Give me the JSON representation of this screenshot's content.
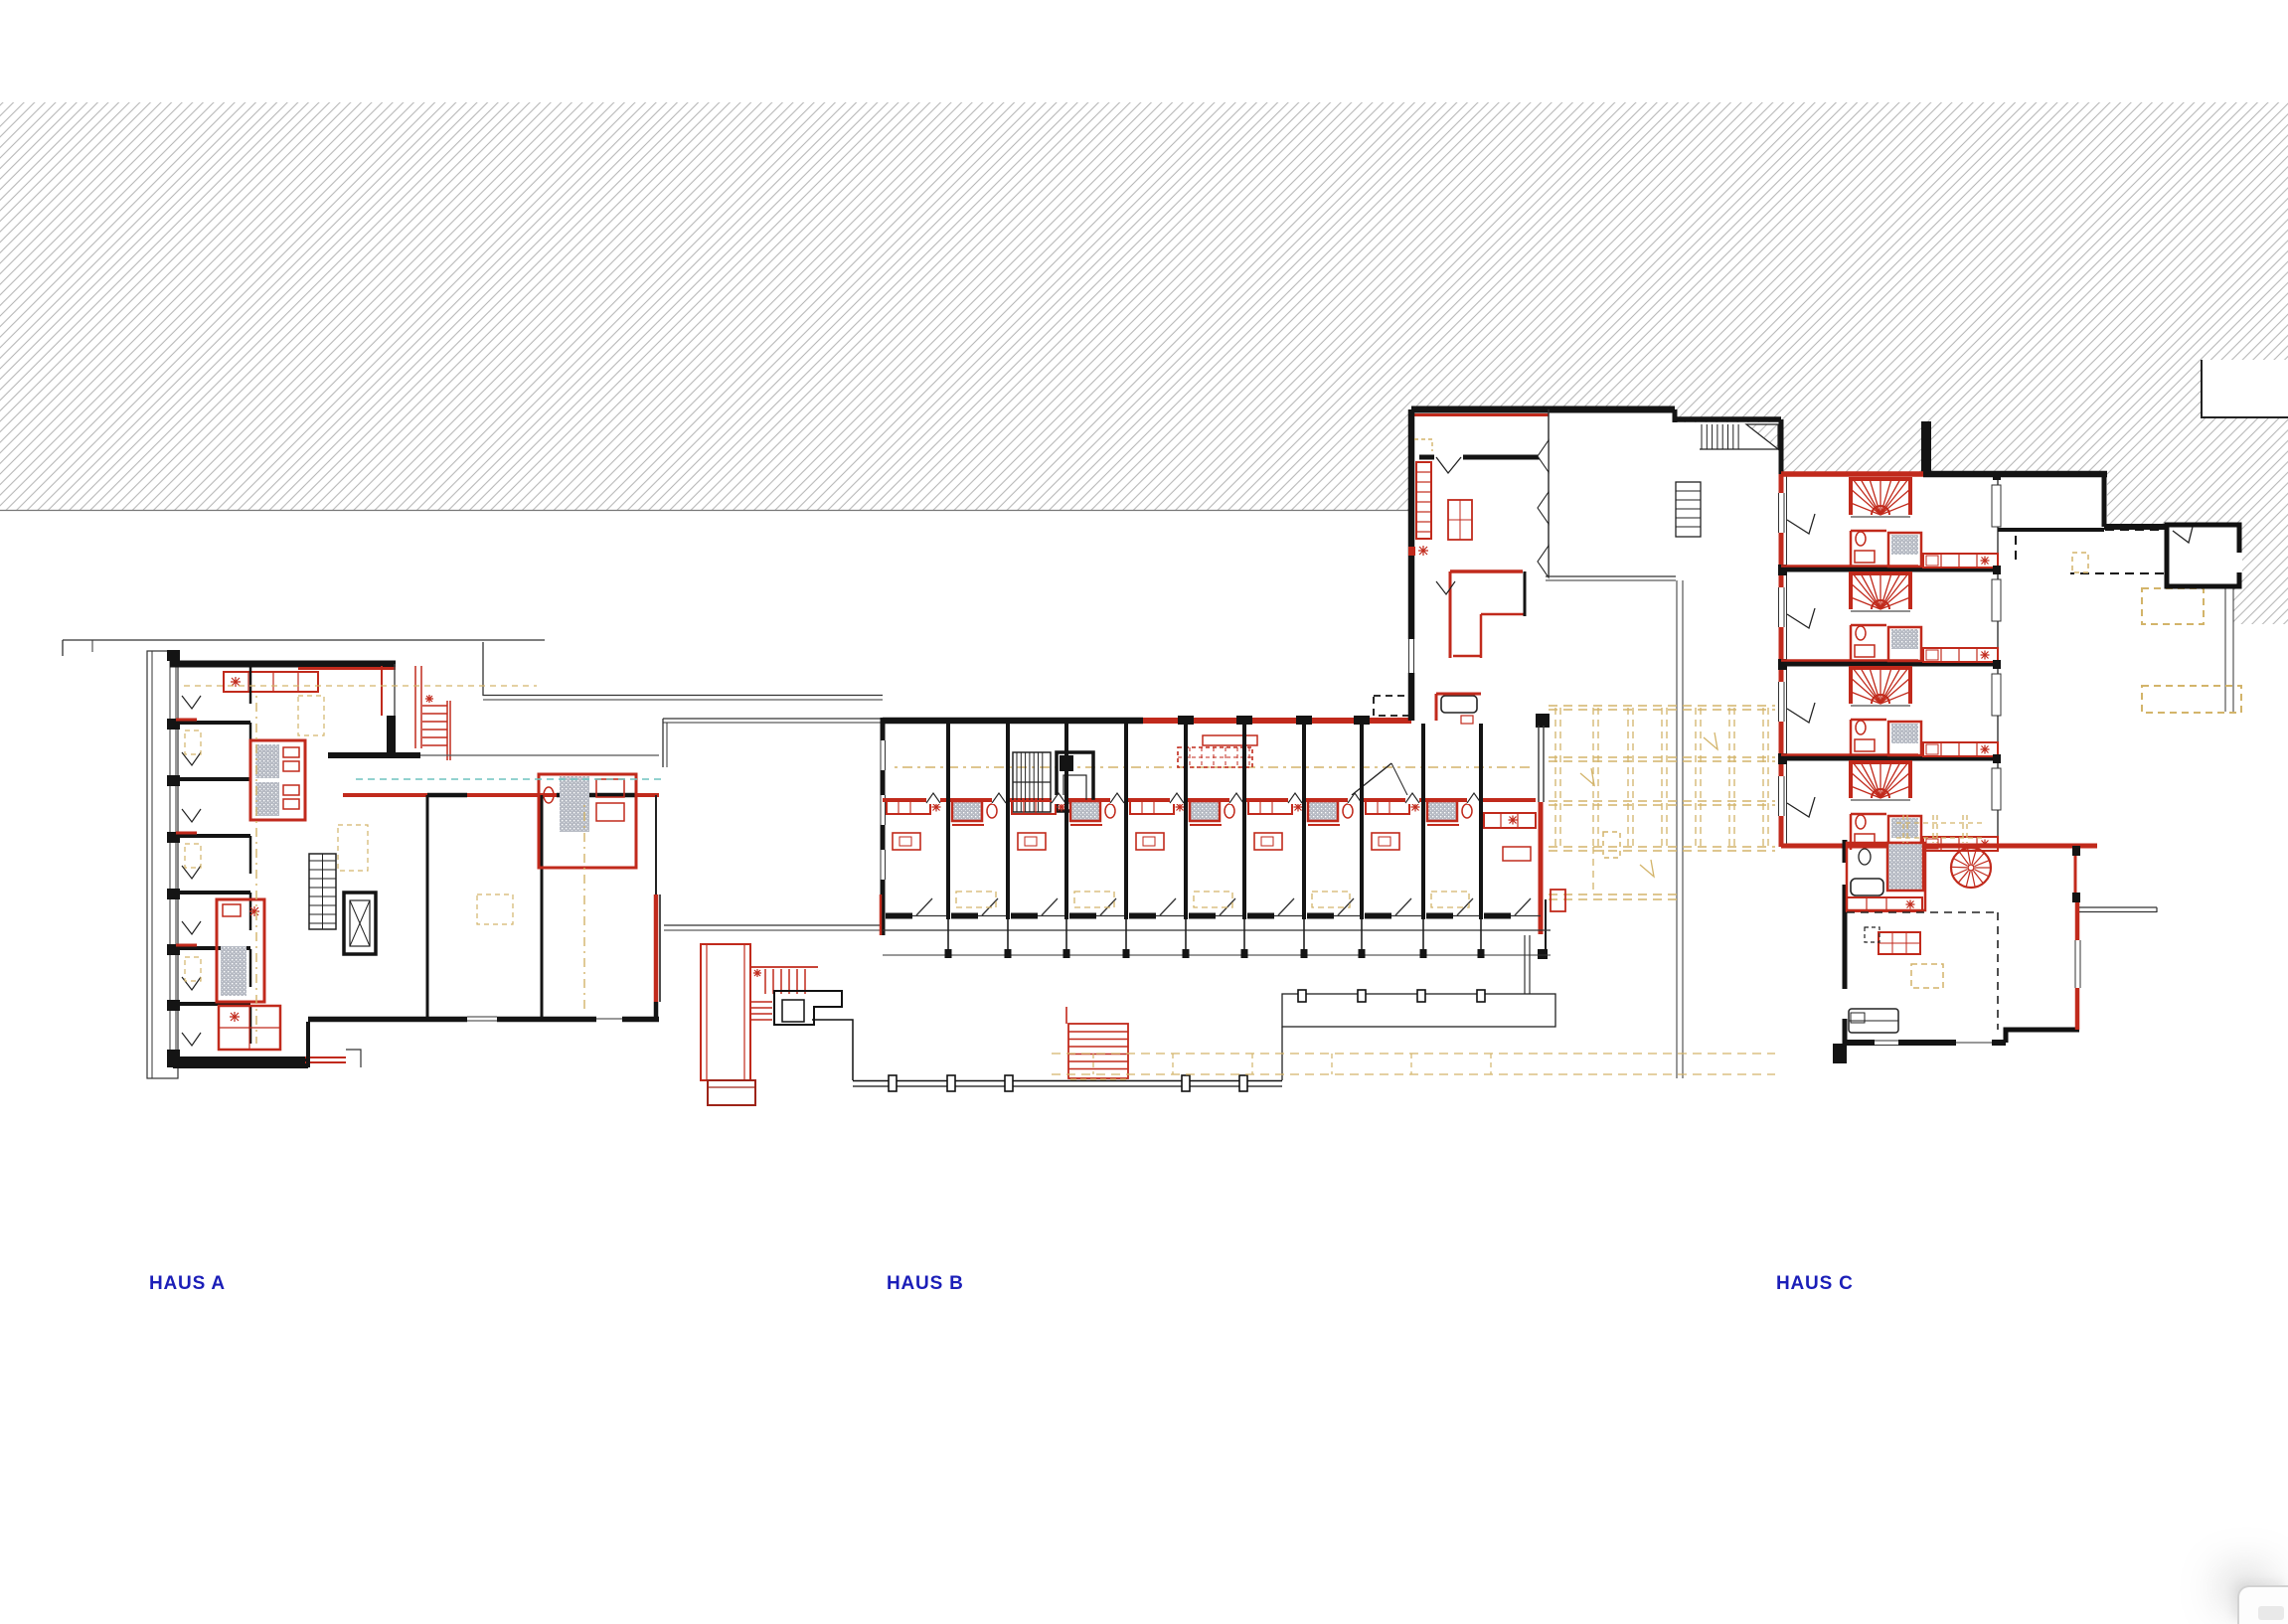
{
  "document": {
    "kind": "architectural floor plan",
    "background": "#ffffff"
  },
  "labels": {
    "haus_a": "HAUS A",
    "haus_b": "HAUS B",
    "haus_c": "HAUS C"
  },
  "colors": {
    "wall": "#141414",
    "red": "#c12a1c",
    "dark_red": "#9e2418",
    "tan": "#d3b46a",
    "hatch": "#b2b2b2",
    "blue": "#1b1eb8",
    "teal": "#6fc4bf",
    "shower": "#b7bbc4"
  }
}
